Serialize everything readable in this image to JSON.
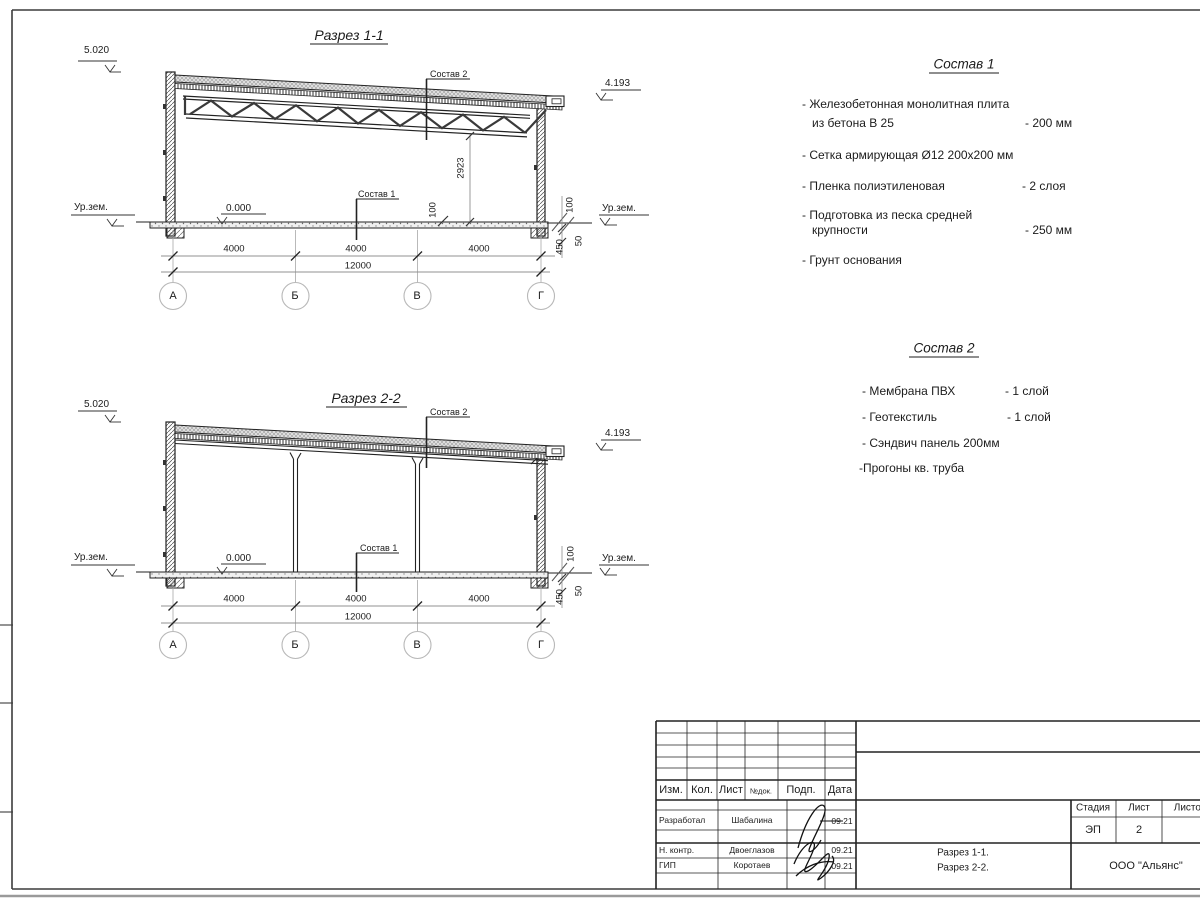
{
  "s1": {
    "title": "Разрез 1-1",
    "elev_top_left": "5.020",
    "elev_top_right": "4.193",
    "elev_zero": "0.000",
    "ground_left": "Ур.зем.",
    "ground_right": "Ур.зем.",
    "leader_roof": "Состав 2",
    "leader_floor": "Состав 1",
    "dim_height": "2923",
    "dim_100_mid": "100",
    "dim_100_right": "100",
    "dim_450": "450",
    "dim_50": "50",
    "span1": "4000",
    "span2": "4000",
    "span3": "4000",
    "total": "12000",
    "axis1": "А",
    "axis2": "Б",
    "axis3": "В",
    "axis4": "Г"
  },
  "s2": {
    "title": "Разрез 2-2",
    "elev_top_left": "5.020",
    "elev_top_right": "4.193",
    "elev_zero": "0.000",
    "ground_left": "Ур.зем.",
    "ground_right": "Ур.зем.",
    "leader_roof": "Состав 2",
    "leader_floor": "Состав 1",
    "dim_100_right": "100",
    "dim_450": "450",
    "dim_50": "50",
    "span1": "4000",
    "span2": "4000",
    "span3": "4000",
    "total": "12000",
    "axis1": "А",
    "axis2": "Б",
    "axis3": "В",
    "axis4": "Г"
  },
  "sostav1": {
    "title": "Состав 1",
    "items": [
      {
        "line1": "- Железобетонная  монолитная плита",
        "line2": "из бетона В 25",
        "value": "- 200 мм"
      },
      {
        "line1": "- Сетка армирующая Ø12 200х200 мм",
        "line2": "",
        "value": ""
      },
      {
        "line1": "- Пленка полиэтиленовая",
        "line2": "",
        "value": "-  2 слоя"
      },
      {
        "line1": "- Подготовка из песка средней",
        "line2": "крупности",
        "value": "- 250 мм"
      },
      {
        "line1": "- Грунт основания",
        "line2": "",
        "value": ""
      }
    ]
  },
  "sostav2": {
    "title": "Состав 2",
    "items": [
      {
        "line1": "- Мембрана ПВХ",
        "value": "- 1 слой"
      },
      {
        "line1": "- Геотекстиль",
        "value": "- 1 слой"
      },
      {
        "line1": "- Сэндвич панель 200мм",
        "value": ""
      },
      {
        "line1": "-Прогоны кв. труба",
        "value": ""
      }
    ]
  },
  "titleblock": {
    "col_izm": "Изм.",
    "col_kol": "Кол.",
    "col_list": "Лист",
    "col_ndok": "№док.",
    "col_podp": "Подп.",
    "col_data": "Дата",
    "role1": "Разработал",
    "name1": "Шабалина",
    "date1": "09.21",
    "role2": "Н. контр.",
    "name2": "Двоеглазов",
    "date2": "09.21",
    "role3": "ГИП",
    "name3": "Коротаев",
    "date3": "09.21",
    "stage_label": "Стадия",
    "list_label": "Лист",
    "listov_label": "Листов",
    "stage": "ЭП",
    "list_no": "2",
    "doc1": "Разрез 1-1.",
    "doc2": "Разрез 2-2.",
    "org": "ООО \"Альянс\""
  }
}
